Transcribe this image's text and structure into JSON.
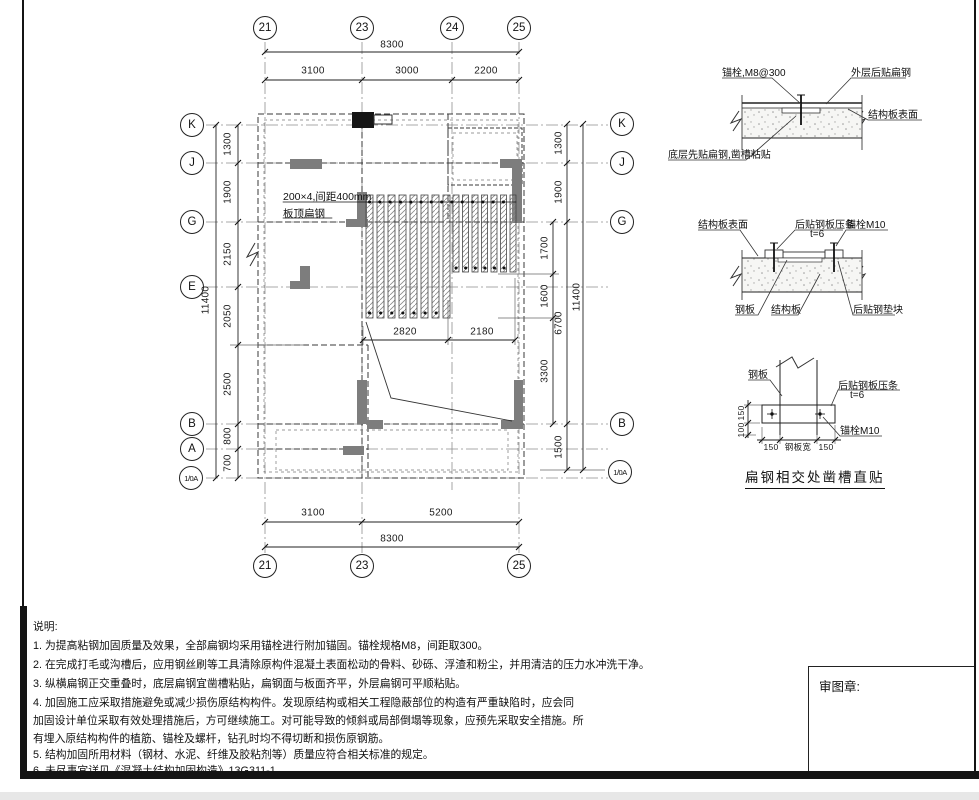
{
  "sheet": {
    "plan": {
      "grid_top": [
        "21",
        "23",
        "24",
        "25"
      ],
      "grid_bottom": [
        "21",
        "23",
        "25"
      ],
      "grid_left": [
        "K",
        "J",
        "G",
        "E",
        "B",
        "A",
        "1/0A"
      ],
      "grid_right": [
        "K",
        "J",
        "G",
        "B",
        "1/0A"
      ],
      "dim_top_total": "8300",
      "dim_top": [
        "3100",
        "3000",
        "2200"
      ],
      "dim_bottom": [
        "3100",
        "5200"
      ],
      "dim_bottom_total": "8300",
      "dim_left": [
        "1300",
        "1900",
        "2150",
        "2050",
        "2500",
        "800",
        "700"
      ],
      "dim_left_total": "11400",
      "dim_right_inner": [
        "1700",
        "1600",
        "3300"
      ],
      "dim_right_mid": [
        "1300",
        "1900",
        "6700",
        "1500"
      ],
      "dim_right_total": "11400",
      "dim_strips": [
        "2820",
        "2180"
      ],
      "annotation_line1": "200×4,间距400mm",
      "annotation_line2": "板顶扁钢"
    },
    "detail_top": {
      "anchor": "锚栓,M8@300",
      "outer": "外层后贴扁钢",
      "surface": "结构板表面",
      "bottom_layer": "底层先贴扁钢,凿槽粘贴"
    },
    "detail_mid": {
      "surface": "结构板表面",
      "batten": "后贴钢板压条",
      "thickness": "t=6",
      "anchor": "锚栓M10",
      "plate": "钢板",
      "slab": "结构板",
      "pad": "后贴钢垫块"
    },
    "detail_bottom": {
      "plate": "钢板",
      "batten": "后贴钢板压条",
      "thickness": "t=6",
      "anchor": "锚栓M10",
      "dim_v": [
        "150",
        "100"
      ],
      "dim_h": [
        "150",
        "钢板宽",
        "150"
      ],
      "title": "扁钢相交处凿槽直贴"
    },
    "notes": {
      "title": "说明:",
      "lines": [
        "1. 为提高粘钢加固质量及效果，全部扁钢均采用锚栓进行附加锚固。锚栓规格M8，间距取300。",
        "2. 在完成打毛或沟槽后，应用钢丝刷等工具清除原构件混凝土表面松动的骨料、砂砾、浮渣和粉尘，并用清洁的压力水冲洗干净。",
        "3. 纵横扁钢正交重叠时，底层扁钢宜凿槽粘贴，扁钢面与板面齐平，外层扁钢可平顺粘贴。",
        "4. 加固施工应采取措施避免或减少损伤原结构构件。发现原结构或相关工程隐蔽部位的构造有严重缺陷时，应会同",
        "加固设计单位采取有效处理措施后，方可继续施工。对可能导致的倾斜或局部倒塌等现象，应预先采取安全措施。所",
        "有埋入原结构构件的植筋、锚栓及螺杆，钻孔时均不得切断和损伤原钢筋。",
        "5. 结构加固所用材料（钢材、水泥、纤维及胶粘剂等）质量应符合相关标准的规定。",
        "6. 未尽事宜详见《混凝土结构加固构造》13G311-1。"
      ]
    },
    "stamp_label": "审图章:"
  }
}
